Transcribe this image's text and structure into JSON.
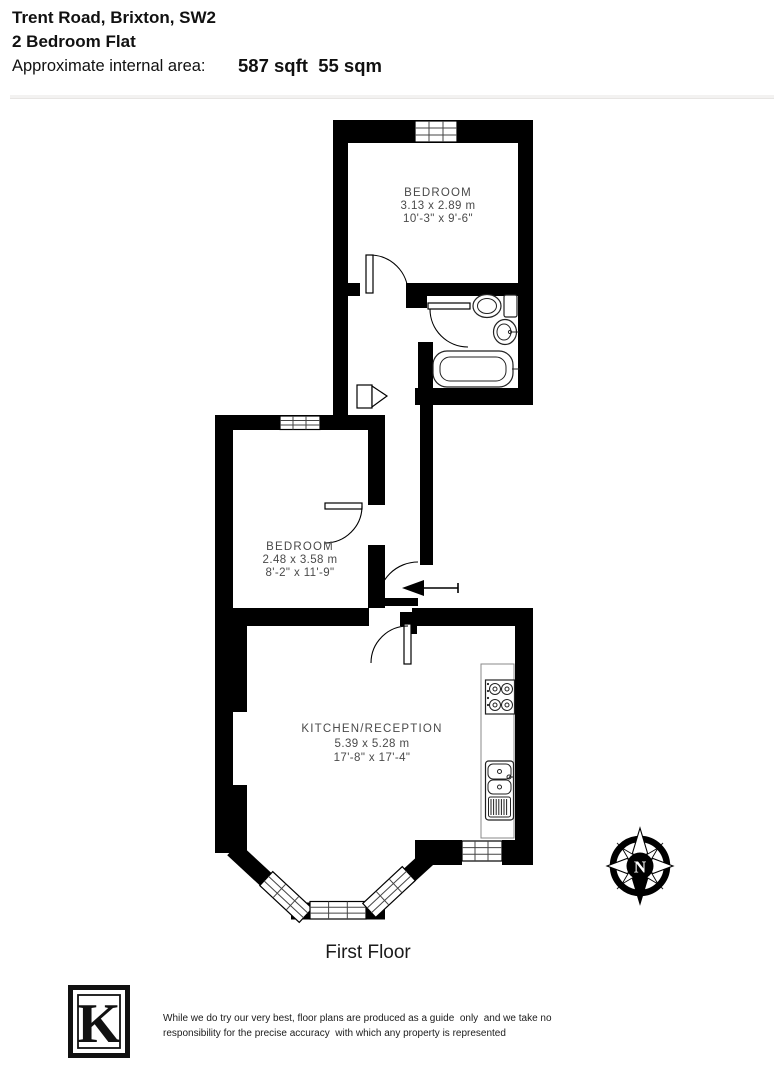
{
  "header": {
    "address": "Trent Road, Brixton, SW2",
    "property_type": "2 Bedroom Flat",
    "area_label": "Approximate internal area:",
    "area_value": "587 sqft  55 sqm"
  },
  "plan": {
    "rooms": [
      {
        "name": "BEDROOM",
        "metric": "3.13 x 2.89 m",
        "imperial": "10'-3\" x 9'-6\""
      },
      {
        "name": "BEDROOM",
        "metric": "2.48 x 3.58 m",
        "imperial": "8'-2\" x 11'-9\""
      },
      {
        "name": "KITCHEN/RECEPTION",
        "metric": "5.39 x 5.28 m",
        "imperial": "17'-8\" x 17'-4\""
      }
    ],
    "floor_label": "First Floor",
    "compass_letter": "N"
  },
  "footer": {
    "logo_letter": "K",
    "disclaimer_line1": "While we do try our very best, floor plans are produced as a guide  only  and we take no",
    "disclaimer_line2": "responsibility for the precise accuracy  with which any property is represented"
  },
  "colors": {
    "wall": "#000000",
    "room_label": "#4a4a4a",
    "divider": "#efefef"
  }
}
